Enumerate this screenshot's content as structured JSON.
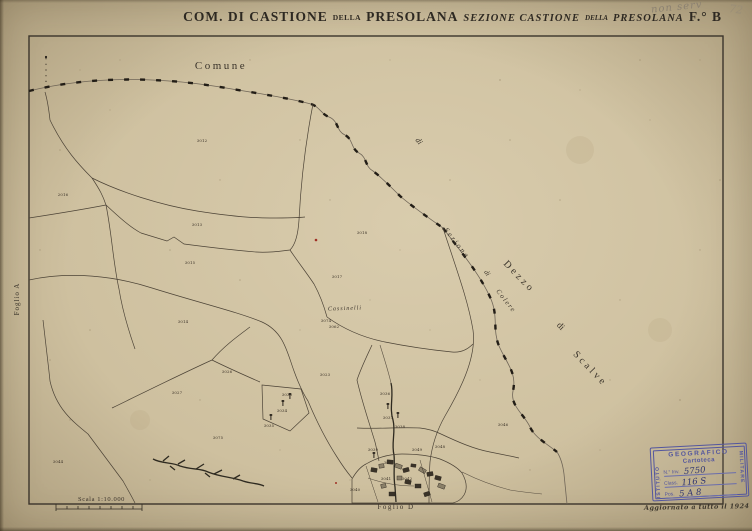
{
  "colors": {
    "paper": "#cec09f",
    "ink": "#3a332a",
    "stamp_blue": "#53569e",
    "stamp_handwriting": "#2f3570",
    "red_mark": "#a03025",
    "pencil": "#8b8171"
  },
  "handwriting": {
    "top_note": "non serv",
    "top_number": "72",
    "updated_note": "Aggiornato a tutto il 1924"
  },
  "title": {
    "part1": "COM. DI CASTIONE",
    "della1": "DELLA",
    "part2": "PRESOLANA",
    "section1": "SEZIONE CASTIONE",
    "della2": "DELLA",
    "section2": "PRESOLANA",
    "sheet": "F.° B"
  },
  "scale": {
    "label": "Scala 1:10.000"
  },
  "stamp": {
    "top": "GEOGRAFICO",
    "left": "ISTITUTO",
    "right": "MILITARE",
    "cartoteca": "Cartoteca",
    "inv_label": "N.° Inv.",
    "inv_value": "5750",
    "class_label": "Class.",
    "class_value": "116 S",
    "pos_label": "Pos.",
    "pos_value": "5 A 8"
  },
  "map_labels": [
    {
      "text": "Comune",
      "x": 221,
      "y": 66,
      "size": 11,
      "ls": 2.5,
      "rot": 0,
      "italic": false
    },
    {
      "text": "di",
      "x": 419,
      "y": 141,
      "size": 8,
      "ls": 0,
      "rot": 52,
      "italic": true
    },
    {
      "text": "Sezione",
      "x": 457,
      "y": 243,
      "size": 7.5,
      "ls": 2,
      "rot": 52,
      "italic": true
    },
    {
      "text": "di",
      "x": 487,
      "y": 273,
      "size": 7,
      "ls": 0,
      "rot": 52,
      "italic": true
    },
    {
      "text": "Colere",
      "x": 506,
      "y": 301,
      "size": 7,
      "ls": 1.5,
      "rot": 52,
      "italic": true
    },
    {
      "text": "Dezzo",
      "x": 519,
      "y": 277,
      "size": 10,
      "ls": 3,
      "rot": 46,
      "italic": false
    },
    {
      "text": "di",
      "x": 561,
      "y": 326,
      "size": 9,
      "ls": 0,
      "rot": 46,
      "italic": false
    },
    {
      "text": "Scalve",
      "x": 590,
      "y": 369,
      "size": 10,
      "ls": 3,
      "rot": 46,
      "italic": false
    },
    {
      "text": "Cassinelli",
      "x": 345,
      "y": 309,
      "size": 6,
      "ls": 1,
      "rot": -2,
      "italic": true
    },
    {
      "text": "Foglio A",
      "x": 17,
      "y": 299,
      "size": 7,
      "ls": 1,
      "rot": -90,
      "italic": false
    },
    {
      "text": "Foglio D",
      "x": 396,
      "y": 507,
      "size": 7,
      "ls": 1.5,
      "rot": 0,
      "italic": false
    }
  ],
  "parcels": [
    {
      "n": "3012",
      "x": 202,
      "y": 141
    },
    {
      "n": "2016",
      "x": 63,
      "y": 195
    },
    {
      "n": "3013",
      "x": 197,
      "y": 225
    },
    {
      "n": "3015",
      "x": 190,
      "y": 263
    },
    {
      "n": "3014",
      "x": 183,
      "y": 322
    },
    {
      "n": "3018",
      "x": 362,
      "y": 233
    },
    {
      "n": "3017",
      "x": 337,
      "y": 277
    },
    {
      "n": "3074",
      "x": 326,
      "y": 321
    },
    {
      "n": "3062",
      "x": 334,
      "y": 327
    },
    {
      "n": "3026",
      "x": 227,
      "y": 372
    },
    {
      "n": "3023",
      "x": 325,
      "y": 375
    },
    {
      "n": "3027",
      "x": 177,
      "y": 393
    },
    {
      "n": "3075",
      "x": 218,
      "y": 438
    },
    {
      "n": "3044",
      "x": 58,
      "y": 462
    },
    {
      "n": "3033",
      "x": 287,
      "y": 395
    },
    {
      "n": "3034",
      "x": 282,
      "y": 411
    },
    {
      "n": "3035",
      "x": 269,
      "y": 426
    },
    {
      "n": "3036",
      "x": 385,
      "y": 394
    },
    {
      "n": "3037",
      "x": 388,
      "y": 418
    },
    {
      "n": "3038",
      "x": 400,
      "y": 427
    },
    {
      "n": "3039",
      "x": 373,
      "y": 450
    },
    {
      "n": "3049",
      "x": 417,
      "y": 450
    },
    {
      "n": "3046",
      "x": 503,
      "y": 425
    },
    {
      "n": "3048",
      "x": 440,
      "y": 447
    },
    {
      "n": "3040",
      "x": 355,
      "y": 490
    },
    {
      "n": "3041",
      "x": 386,
      "y": 479
    },
    {
      "n": "3042",
      "x": 407,
      "y": 479
    },
    {
      "n": "3045",
      "x": 389,
      "y": 463
    }
  ],
  "symbols": [
    {
      "x": 290,
      "y": 399
    },
    {
      "x": 283,
      "y": 406
    },
    {
      "x": 271,
      "y": 420
    },
    {
      "x": 388,
      "y": 409
    },
    {
      "x": 398,
      "y": 418
    },
    {
      "x": 374,
      "y": 458
    }
  ]
}
